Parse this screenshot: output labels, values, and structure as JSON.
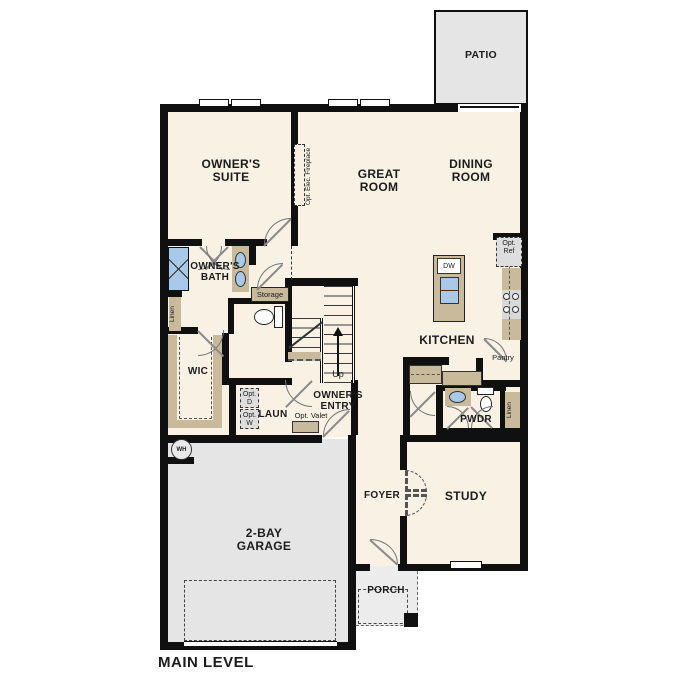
{
  "title": "MAIN LEVEL",
  "labels": {
    "patio": "PATIO",
    "owners_suite": "OWNER'S SUITE",
    "great_room": "GREAT ROOM",
    "dining_room": "DINING ROOM",
    "opt_fireplace": "Opt. Elec. Fireplace",
    "owners_bath": "OWNER'S BATH",
    "storage": "Storage",
    "linen_left": "Linen",
    "wic": "WIC",
    "opt_d": "Opt. D",
    "opt_w": "Opt. W",
    "laundry": "LAUN",
    "opt_valet": "Opt. Valet",
    "owners_entry": "OWNER'S ENTRY",
    "up": "Up",
    "kitchen": "KITCHEN",
    "dw": "DW",
    "opt_ref": "Opt. Ref",
    "pantry": "Pantry",
    "pwdr": "PWDR",
    "linen_right": "Linen",
    "foyer": "FOYER",
    "study": "STUDY",
    "garage": "2-BAY GARAGE",
    "porch": "PORCH",
    "wh": "WH"
  },
  "colors": {
    "floor": "#f8f1e4",
    "wall": "#101010",
    "casework": "#c9ba9c",
    "fixture_blue": "#a9c9e9",
    "exterior_concrete": "#e5e5e5",
    "appliance_gray": "#dedede"
  }
}
